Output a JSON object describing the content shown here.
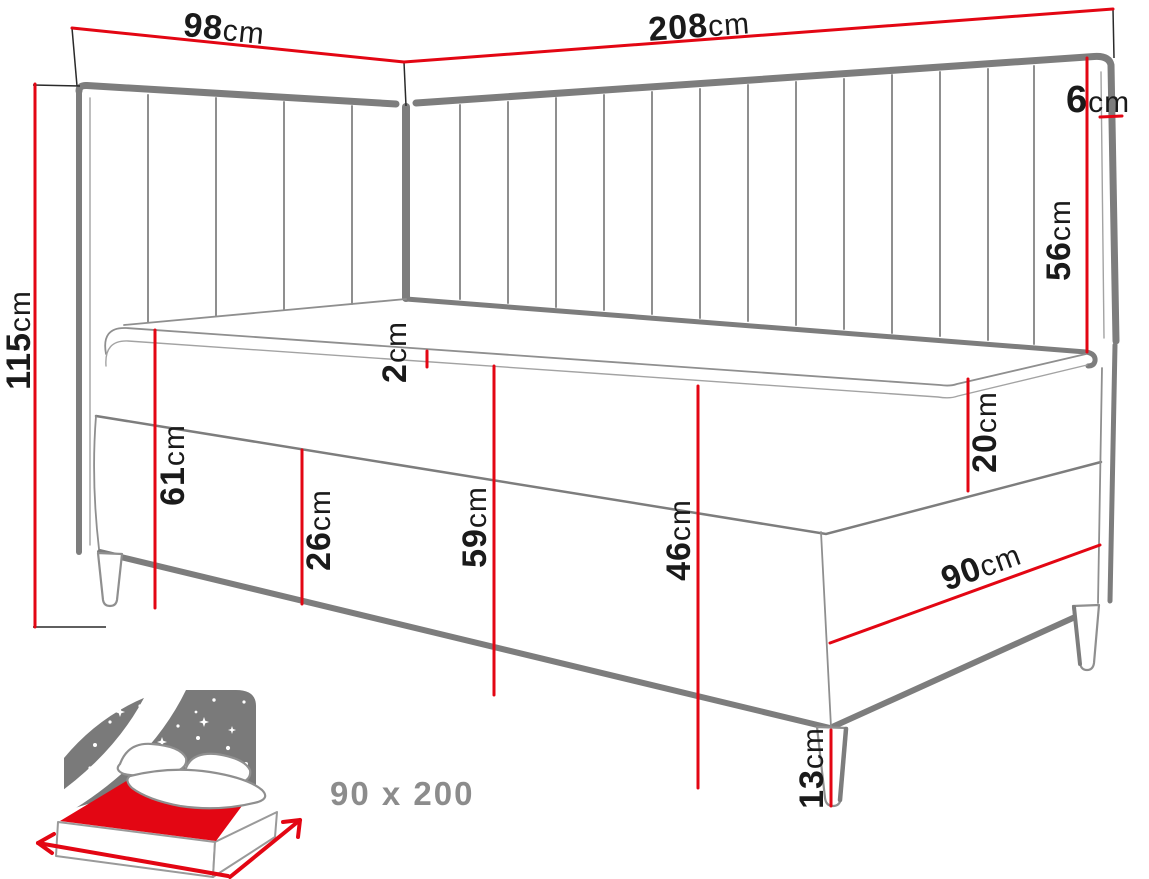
{
  "diagram": {
    "dimensions": {
      "short_headboard_width": {
        "value": "98",
        "unit": "cm"
      },
      "long_headboard_width": {
        "value": "208",
        "unit": "cm"
      },
      "headboard_thickness": {
        "value": "6",
        "unit": "cm"
      },
      "headboard_above_mattress": {
        "value": "56",
        "unit": "cm"
      },
      "total_height": {
        "value": "115",
        "unit": "cm"
      },
      "mattress_topper_thickness": {
        "value": "2",
        "unit": "cm"
      },
      "sleep_surface_height": {
        "value": "61",
        "unit": "cm"
      },
      "lower_box_height": {
        "value": "26",
        "unit": "cm"
      },
      "base_height": {
        "value": "59",
        "unit": "cm"
      },
      "upholstered_box_height": {
        "value": "46",
        "unit": "cm"
      },
      "upper_box_height": {
        "value": "20",
        "unit": "cm"
      },
      "bed_foot_width": {
        "value": "90",
        "unit": "cm"
      },
      "leg_height": {
        "value": "13",
        "unit": "cm"
      }
    },
    "badge": {
      "size_label": "90 x 200"
    },
    "colors": {
      "dimension_red": "#e30613",
      "outline_gray": "#7d7d7d",
      "icon_gray": "#7a7a7a",
      "label_black": "#1a1a1a",
      "badge_gray": "#8c8c8c"
    }
  }
}
